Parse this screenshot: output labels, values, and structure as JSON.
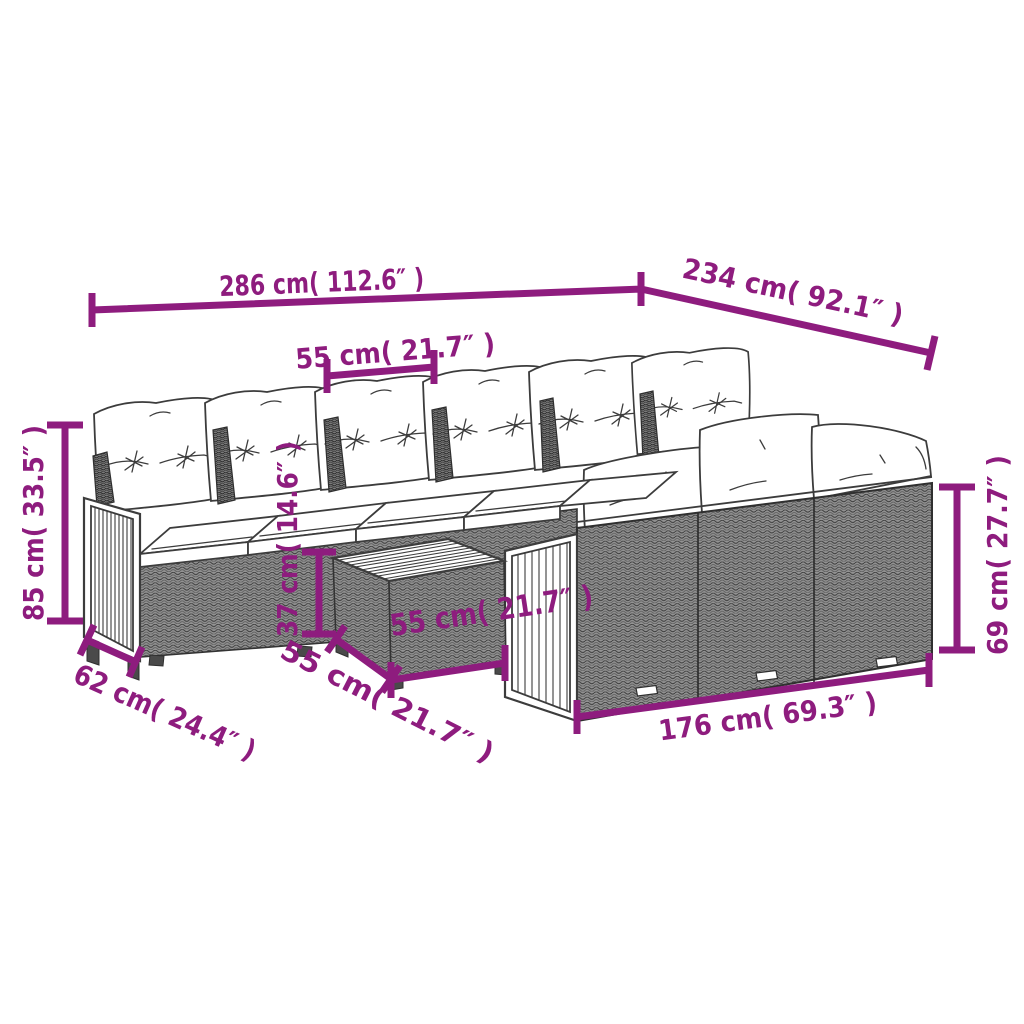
{
  "diagram": {
    "kind": "furniture-dimension-diagram",
    "subject": "rattan-corner-sofa-set-with-cushions-and-coffee-table"
  },
  "colors": {
    "dimension_accent": "#8E1C7E",
    "line_art_outline": "#3C3C3C",
    "rattan_fill": "#929292",
    "cushion_fill": "#FFFFFF",
    "background": "#FFFFFF"
  },
  "dimensions": {
    "total_width": "286 cm( 112.6″ )",
    "total_depth": "234 cm( 92.1″ )",
    "seat_width": "55 cm( 21.7″ )",
    "back_height": "85 cm( 33.5″ )",
    "table_height": "37 cm( 14.6″ )",
    "arm_depth": "62 cm( 24.4″ )",
    "seat_depth": "55 cm( 21.7″ )",
    "table_width": "55 cm( 21.7″ )",
    "right_section_width": "176 cm( 69.3″ )",
    "right_back_height": "69 cm( 27.7″ )"
  }
}
